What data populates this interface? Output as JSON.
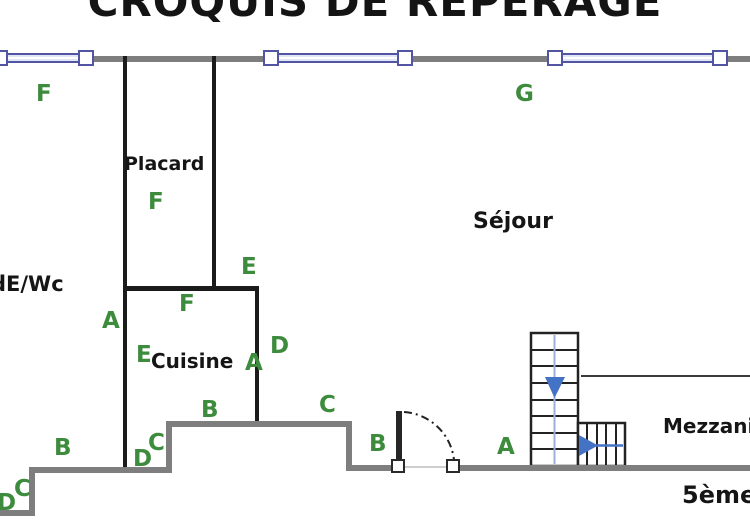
{
  "title": "CROQUIS DE REPÉRAGE",
  "labels": {
    "placard": "Placard",
    "cuisine": "Cuisine",
    "bathroom": "dE/Wc",
    "sejour": "Séjour",
    "mezzanine": "Mezzanine",
    "floor": "5ème"
  },
  "markers": [
    "F",
    "G",
    "F",
    "E",
    "F",
    "A",
    "E",
    "A",
    "D",
    "B",
    "C",
    "C",
    "D",
    "B",
    "C",
    "D",
    "B",
    "A"
  ],
  "colors": {
    "wall_gray": "#7e7e7e",
    "interior_wall": "#1b1b1b",
    "window_frame": "#5155a3",
    "window_fill": "#e2e7f7",
    "marker_green": "#3d8b3d",
    "arrow_blue": "#4472c4",
    "text": "#151515"
  }
}
